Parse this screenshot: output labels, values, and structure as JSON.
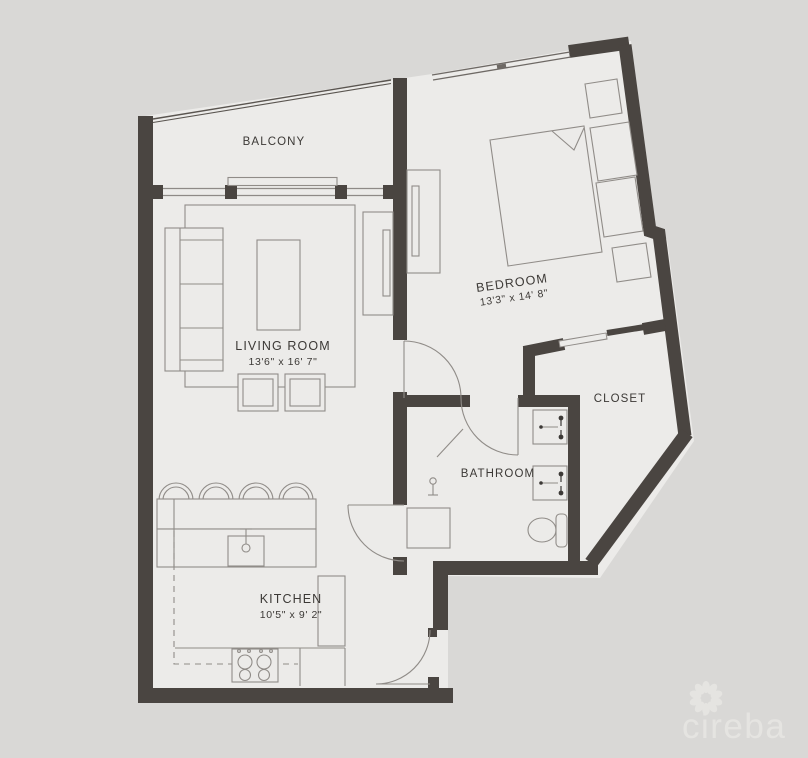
{
  "rooms": {
    "balcony": {
      "label": "BALCONY"
    },
    "living": {
      "label": "LIVING ROOM",
      "dims": "13'6\" x 16' 7\""
    },
    "bedroom": {
      "label": "BEDROOM",
      "dims": "13'3\" x 14' 8\""
    },
    "closet": {
      "label": "CLOSET"
    },
    "bathroom": {
      "label": "BATHROOM"
    },
    "kitchen": {
      "label": "KITCHEN",
      "dims": "10'5\" x 9' 2\""
    }
  },
  "watermark": {
    "brand": "cireba"
  },
  "colors": {
    "wall": "#4a4541",
    "floor": "#ecebe9",
    "background": "#d9d8d6",
    "furniture_line": "#908c88",
    "label_text": "#3c3936",
    "logo": "#e7e6e3"
  }
}
